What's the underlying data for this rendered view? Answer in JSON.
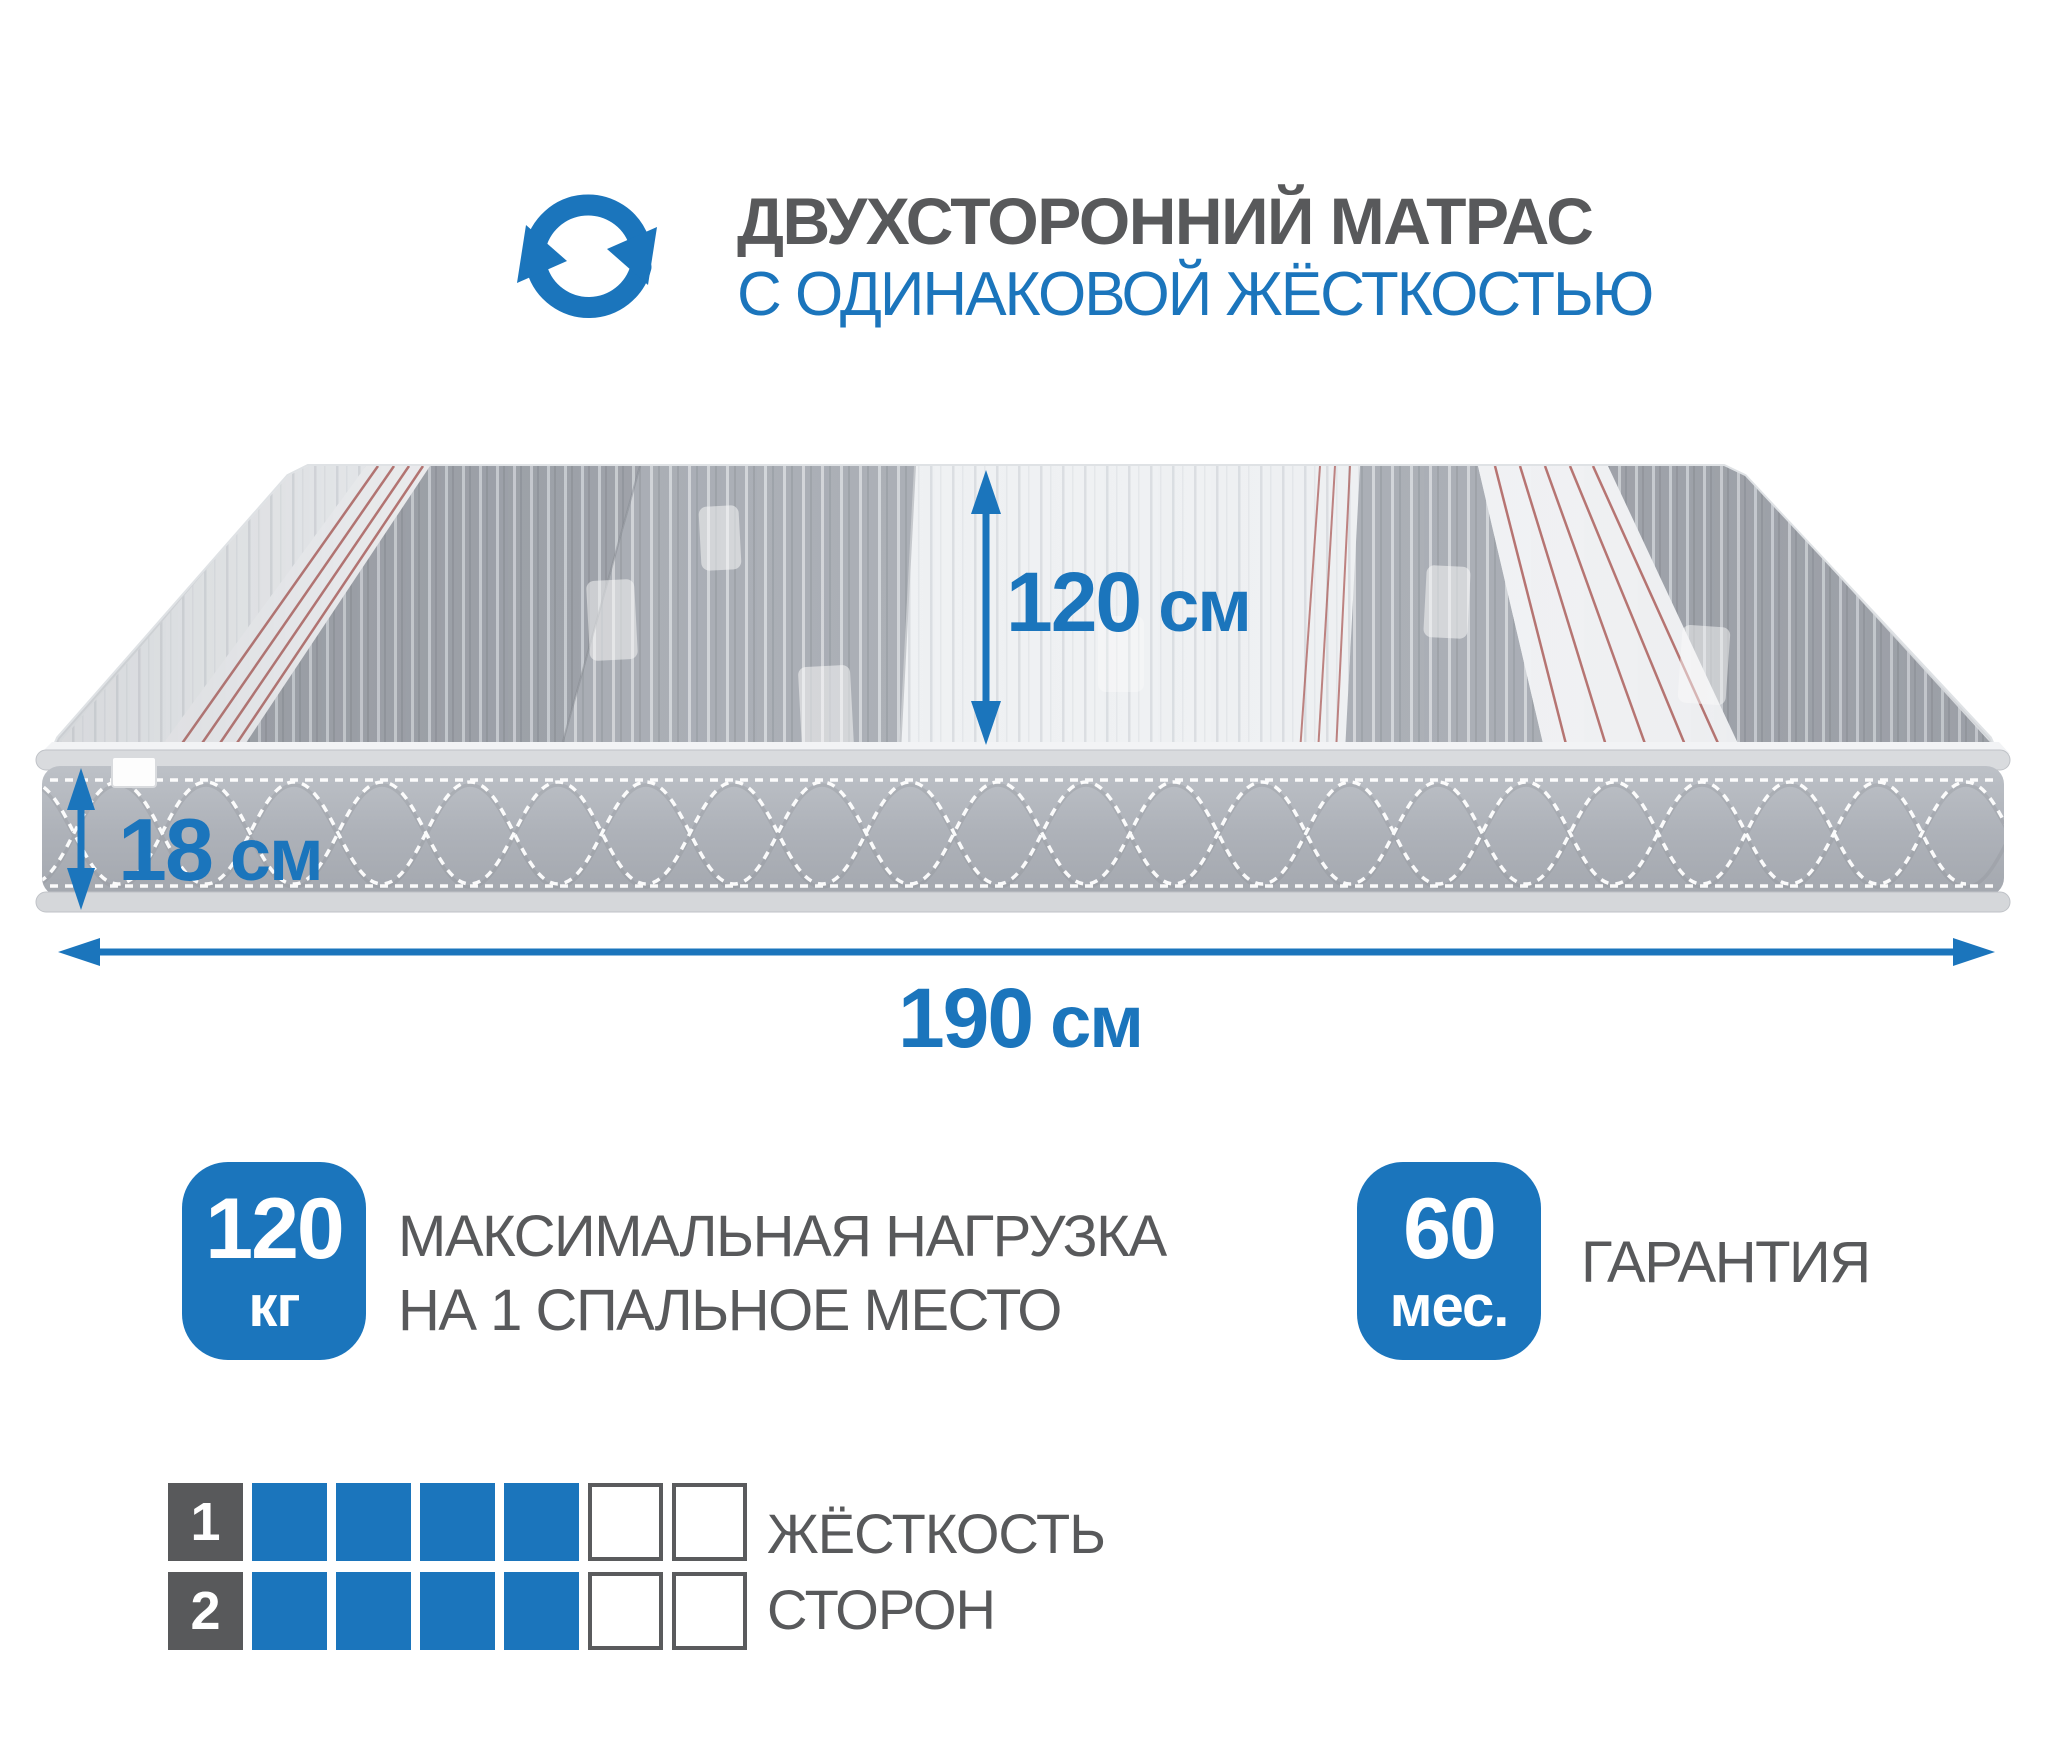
{
  "header": {
    "title": "ДВУХСТОРОННИЙ МАТРАС",
    "subtitle": "С ОДИНАКОВОЙ ЖЁСТКОСТЬЮ",
    "icon": "rotate-arrows-icon"
  },
  "dimensions": {
    "width": {
      "value": "120",
      "unit": "см"
    },
    "height": {
      "value": "18",
      "unit": "см"
    },
    "length": {
      "value": "190",
      "unit": "см"
    }
  },
  "badges": {
    "max_load": {
      "value": "120",
      "unit": "кг",
      "caption_line1": "МАКСИМАЛЬНАЯ НАГРУЗКА",
      "caption_line2": "НА 1 СПАЛЬНОЕ МЕСТО"
    },
    "warranty": {
      "value": "60",
      "unit": "мес.",
      "caption": "ГАРАНТИЯ"
    }
  },
  "firmness": {
    "caption_line1": "ЖЁСТКОСТЬ",
    "caption_line2": "СТОРОН",
    "scale_max": 6,
    "sides": [
      {
        "number": "1",
        "filled": 4
      },
      {
        "number": "2",
        "filled": 4
      }
    ]
  },
  "colors": {
    "accent_blue": "#1b75bc",
    "text_gray": "#58595b",
    "fabric_gray_dark": "#9fa3aa",
    "fabric_gray_light": "#abafb6",
    "fabric_white": "#eff1f3",
    "pinstripe_red": "#a9534f",
    "side_gray": "#b0b4ba"
  }
}
